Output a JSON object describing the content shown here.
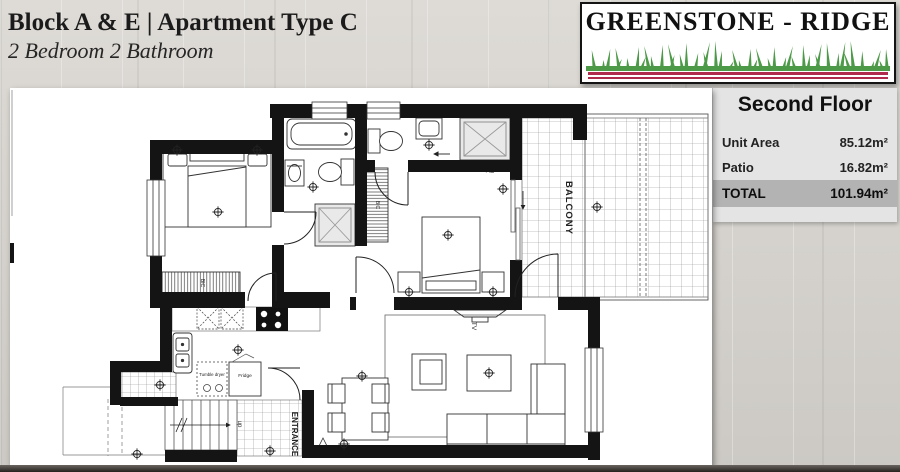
{
  "header": {
    "title": "Block A & E | Apartment Type C",
    "subtitle": "2 Bedroom 2 Bathroom"
  },
  "logo": {
    "text": "GREENSTONE - RIDGE"
  },
  "info_panel": {
    "floor_title": "Second Floor",
    "rows": [
      {
        "label": "Unit Area",
        "value": "85.12m²"
      },
      {
        "label": "Patio",
        "value": "16.82m²"
      }
    ],
    "total_label": "TOTAL",
    "total_value": "101.94m²"
  },
  "plan_labels": {
    "balcony": "BALCONY",
    "entrance": "ENTRANCE",
    "up": "up",
    "tv": "TV",
    "bic": "BIC",
    "fridge": "Fridge",
    "tumble_dryer": "Tumble dryer"
  },
  "colors": {
    "grass-green": "#4c9a47",
    "logo-red": "#b02a4c",
    "wall-black": "#141414",
    "wood-bg": "#d7d4cf",
    "panel-gray": "#e4e4e4",
    "total-band": "#b3b3b3"
  }
}
